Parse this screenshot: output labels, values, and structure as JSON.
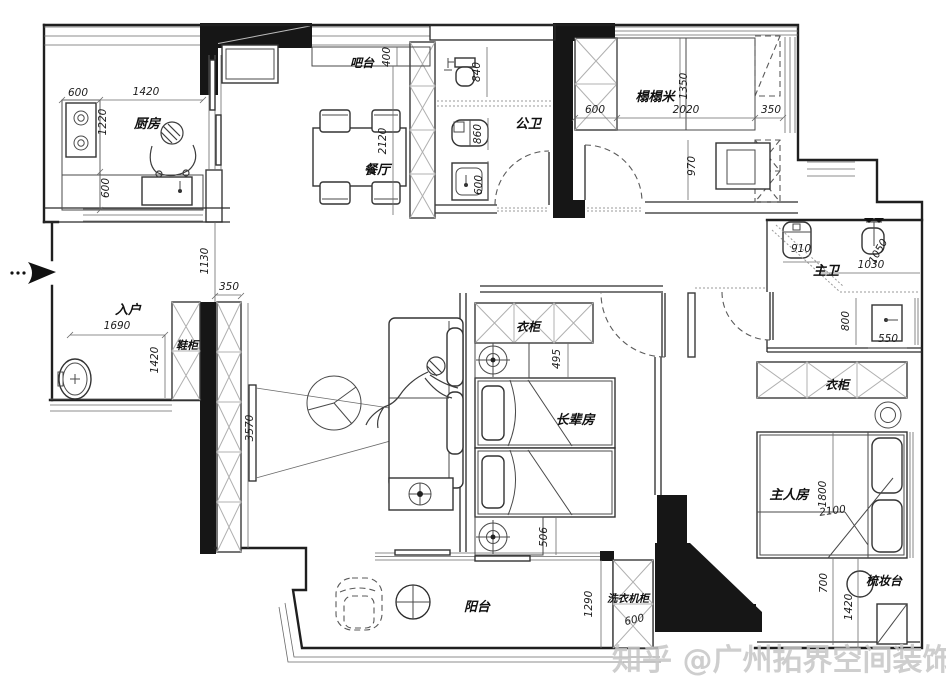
{
  "watermark": "知乎 @广州拓界空间装饰",
  "room_labels": [
    {
      "id": "kitchen",
      "label": "厨房",
      "x": 147,
      "y": 128,
      "r": 0,
      "size": 13
    },
    {
      "id": "bar",
      "label": "吧台",
      "x": 362,
      "y": 67,
      "r": 0,
      "size": 12
    },
    {
      "id": "dining",
      "label": "餐厅",
      "x": 377,
      "y": 174,
      "r": 0,
      "size": 13
    },
    {
      "id": "public-bath",
      "label": "公卫",
      "x": 528,
      "y": 128,
      "r": 0,
      "size": 13
    },
    {
      "id": "tatami",
      "label": "榻榻米",
      "x": 655,
      "y": 101,
      "r": 0,
      "size": 13
    },
    {
      "id": "entry",
      "label": "入户",
      "x": 128,
      "y": 314,
      "r": 0,
      "size": 13
    },
    {
      "id": "shoe-cabinet",
      "label": "鞋柜",
      "x": 187,
      "y": 349,
      "r": 0,
      "size": 11
    },
    {
      "id": "wardrobe-elder",
      "label": "衣柜",
      "x": 528,
      "y": 331,
      "r": 0,
      "size": 12
    },
    {
      "id": "elder-room",
      "label": "长辈房",
      "x": 575,
      "y": 424,
      "r": 0,
      "size": 13
    },
    {
      "id": "master-bath",
      "label": "主卫",
      "x": 826,
      "y": 275,
      "r": 0,
      "size": 13
    },
    {
      "id": "wardrobe-master",
      "label": "衣柜",
      "x": 837,
      "y": 389,
      "r": 0,
      "size": 12
    },
    {
      "id": "master-room",
      "label": "主人房",
      "x": 789,
      "y": 499,
      "r": 0,
      "size": 13
    },
    {
      "id": "dresser",
      "label": "梳妆台",
      "x": 884,
      "y": 585,
      "r": 0,
      "size": 12
    },
    {
      "id": "balcony",
      "label": "阳台",
      "x": 477,
      "y": 611,
      "r": 0,
      "size": 13
    },
    {
      "id": "washer-cabinet",
      "label": "洗衣机柜",
      "x": 628,
      "y": 602,
      "r": 0,
      "size": 10.5
    }
  ],
  "dim_labels": [
    {
      "v": "600",
      "x": 78,
      "y": 96,
      "r": 0
    },
    {
      "v": "1420",
      "x": 146,
      "y": 95,
      "r": 0
    },
    {
      "v": "1220",
      "x": 106,
      "y": 122,
      "r": -90
    },
    {
      "v": "600",
      "x": 109,
      "y": 188,
      "r": -90
    },
    {
      "v": "400",
      "x": 390,
      "y": 57,
      "r": -90
    },
    {
      "v": "2120",
      "x": 386,
      "y": 141,
      "r": -90
    },
    {
      "v": "840",
      "x": 480,
      "y": 72,
      "r": -90
    },
    {
      "v": "860",
      "x": 481,
      "y": 134,
      "r": -90
    },
    {
      "v": "600",
      "x": 482,
      "y": 185,
      "r": -90
    },
    {
      "v": "600",
      "x": 595,
      "y": 113,
      "r": 0
    },
    {
      "v": "2020",
      "x": 686,
      "y": 113,
      "r": 0
    },
    {
      "v": "350",
      "x": 771,
      "y": 113,
      "r": 0
    },
    {
      "v": "1350",
      "x": 687,
      "y": 86,
      "r": -90
    },
    {
      "v": "970",
      "x": 695,
      "y": 166,
      "r": -90
    },
    {
      "v": "1130",
      "x": 208,
      "y": 261,
      "r": -90
    },
    {
      "v": "350",
      "x": 229,
      "y": 290,
      "r": 0
    },
    {
      "v": "1690",
      "x": 117,
      "y": 329,
      "r": 0
    },
    {
      "v": "1420",
      "x": 158,
      "y": 360,
      "r": -90
    },
    {
      "v": "3570",
      "x": 253,
      "y": 428,
      "r": -90
    },
    {
      "v": "495",
      "x": 560,
      "y": 359,
      "r": -90
    },
    {
      "v": "506",
      "x": 547,
      "y": 537,
      "r": -90
    },
    {
      "v": "910",
      "x": 801,
      "y": 252,
      "r": 0
    },
    {
      "v": "1030",
      "x": 871,
      "y": 268,
      "r": 0
    },
    {
      "v": "1050",
      "x": 881,
      "y": 253,
      "r": -60
    },
    {
      "v": "800",
      "x": 849,
      "y": 321,
      "r": -90
    },
    {
      "v": "550",
      "x": 888,
      "y": 342,
      "r": 0
    },
    {
      "v": "1800",
      "x": 826,
      "y": 494,
      "r": -90
    },
    {
      "v": "2100",
      "x": 833,
      "y": 514,
      "r": -8
    },
    {
      "v": "700",
      "x": 827,
      "y": 583,
      "r": -90
    },
    {
      "v": "1420",
      "x": 852,
      "y": 607,
      "r": -90
    },
    {
      "v": "1290",
      "x": 592,
      "y": 604,
      "r": -90
    },
    {
      "v": "600",
      "x": 635,
      "y": 623,
      "r": -12
    }
  ],
  "colors": {
    "wall": "#161616",
    "line": "#2a2a2a",
    "hatch": "#b0b0b0",
    "watermark": "#c6c6c6"
  }
}
